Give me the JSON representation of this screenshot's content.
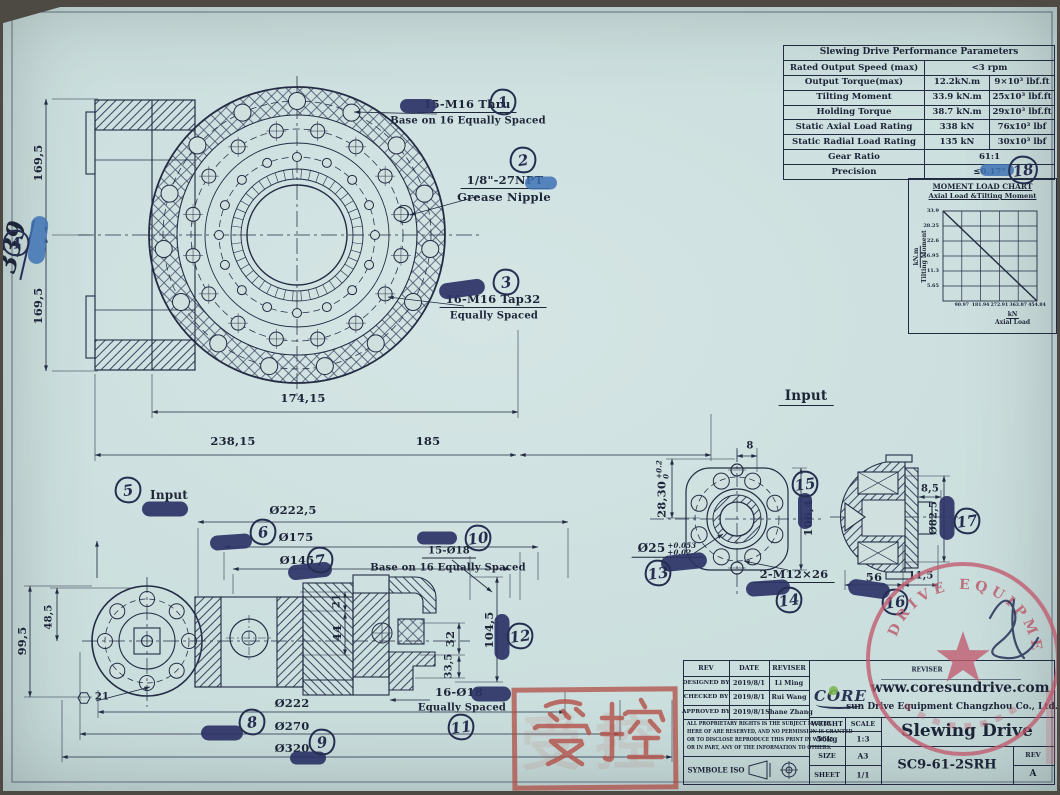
{
  "sheet": {
    "stamp_controlled": "受控",
    "seal_text": "DRIVE EQUIPMENT"
  },
  "perf_table": {
    "title": "Slewing Drive Performance Parameters",
    "rows": [
      {
        "label": "Rated Output Speed (max)",
        "v1": "<3 rpm",
        "v2": ""
      },
      {
        "label": "Output Torque(max)",
        "v1": "12.2kN.m",
        "v2": "9×10³ lbf.ft"
      },
      {
        "label": "Tilting Moment",
        "v1": "33.9 kN.m",
        "v2": "25x10³ lbf.ft"
      },
      {
        "label": "Holding Torque",
        "v1": "38.7 kN.m",
        "v2": "29x10³ lbf.ft"
      },
      {
        "label": "Static Axial Load Rating",
        "v1": "338 kN",
        "v2": "76x10³ lbf"
      },
      {
        "label": "Static Radial Load Rating",
        "v1": "135 kN",
        "v2": "30x10³ lbf"
      },
      {
        "label": "Gear Ratio",
        "v1": "61:1",
        "v2": ""
      },
      {
        "label": "Precision",
        "v1": "≤0.17°",
        "v2": ""
      }
    ]
  },
  "chart_data": {
    "type": "line",
    "title": "MOMENT LOAD CHART",
    "subtitle": "Axial Load &Tilting Moment",
    "ylabel_unit": "kN.m",
    "ylabel": "Tilting Moment",
    "xlabel_unit": "kN",
    "xlabel": "Axial Load",
    "y_ticks": [
      "33.9",
      "28.25",
      "22.6",
      "16.95",
      "11.3",
      "5.65"
    ],
    "x_ticks": [
      "90.97",
      "181.94",
      "272.91",
      "363.87",
      "454.84"
    ],
    "xlim": [
      0,
      454.84
    ],
    "ylim": [
      0,
      33.9
    ],
    "grid": true,
    "legend": false,
    "line": [
      [
        0,
        33.9
      ],
      [
        454.84,
        0
      ]
    ]
  },
  "callouts": {
    "c1a": "15-M16 Thru",
    "c1b": "Base on 16 Equally Spaced",
    "c2a": "1/8\"-27NPT",
    "c2b": "Grease Nipple",
    "c3a": "16-M16 Tap32",
    "c3b": "Equally Spaced",
    "c10a": "15-Ø18",
    "c10b": "Base on 16 Equally Spaced",
    "c11a": "16-Ø18",
    "c11b": "Equally Spaced"
  },
  "labels": {
    "input_main": "Input",
    "input_small": "Input"
  },
  "dims": {
    "v169a": "169,5",
    "v169b": "169,5",
    "hand": "339",
    "h17415": "174,15",
    "h23815": "238,15",
    "h185": "185",
    "o2225": "Ø222,5",
    "o175": "Ø175",
    "o145": "Ø145",
    "s21": "21",
    "s44": "44",
    "s32": "32",
    "s335": "33,5",
    "s1045": "104,5",
    "s995": "99,5",
    "s485": "48,5",
    "s21b": "21",
    "o222": "Ø222",
    "o270": "Ø270",
    "o320": "Ø320",
    "i8": "8",
    "i2830": "28,30",
    "i2830tu": "+0.2",
    "i2830tl": "0",
    "i1064": "106,4",
    "i25": "Ø25",
    "i25tu": "+0.053",
    "i25tl": "+0.02",
    "im12": "2-M12×26",
    "m85": "8,5",
    "mo825": "Ø82,5",
    "m56": "56",
    "m115": "11,5"
  },
  "badges": {
    "b1": "1",
    "b2": "2",
    "b3": "3",
    "b4": "4",
    "b5": "5",
    "b6": "6",
    "b7": "7",
    "b8": "8",
    "b9": "9",
    "b10": "10",
    "b11": "11",
    "b12": "12",
    "b13": "13",
    "b14": "14",
    "b15": "15",
    "b16": "16",
    "b17": "17",
    "b18": "18"
  },
  "title_block": {
    "col_rev": "REV",
    "col_date": "DATE",
    "col_reviser": "REVISER",
    "rows": [
      {
        "label": "DESIGNED BY",
        "date": "2019/8/1",
        "name": "Li Ming"
      },
      {
        "label": "CHECKED BY",
        "date": "2019/8/1",
        "name": "Rui Wang"
      },
      {
        "label": "APPROVED BY",
        "date": "2019/8/1",
        "name": "Shane Zhang"
      }
    ],
    "proprietary": [
      "ALL PROPRIETARY RIGHTS IS THE SUBJECT MATTER",
      "HERE OF ARE RESERVED, AND NO PERMISSION IS GRANTED",
      "OR TO DISCLOSE REPRODUCE THIS PRINT IN WHOLE",
      "OR IN PART, ANY OF THE INFORMATION TO OTHERS."
    ],
    "symbole": "SYMBOLE ISO",
    "weight_label": "WEIGHT",
    "weight": "56kg",
    "scale_label": "SCALE",
    "scale": "1:3",
    "size_label": "SIZE",
    "size": "A3",
    "sheet_label": "SHEET",
    "sheet": "1/1",
    "reviser2": "REVISER",
    "website": "www.coresundrive.com",
    "logo": "CORE",
    "company": "sun Drive Equipment Changzhou Co., Ltd.",
    "product": "Slewing Drive",
    "model": "SC9-61-2SRH",
    "rev_label": "REV",
    "rev_value": "A"
  }
}
